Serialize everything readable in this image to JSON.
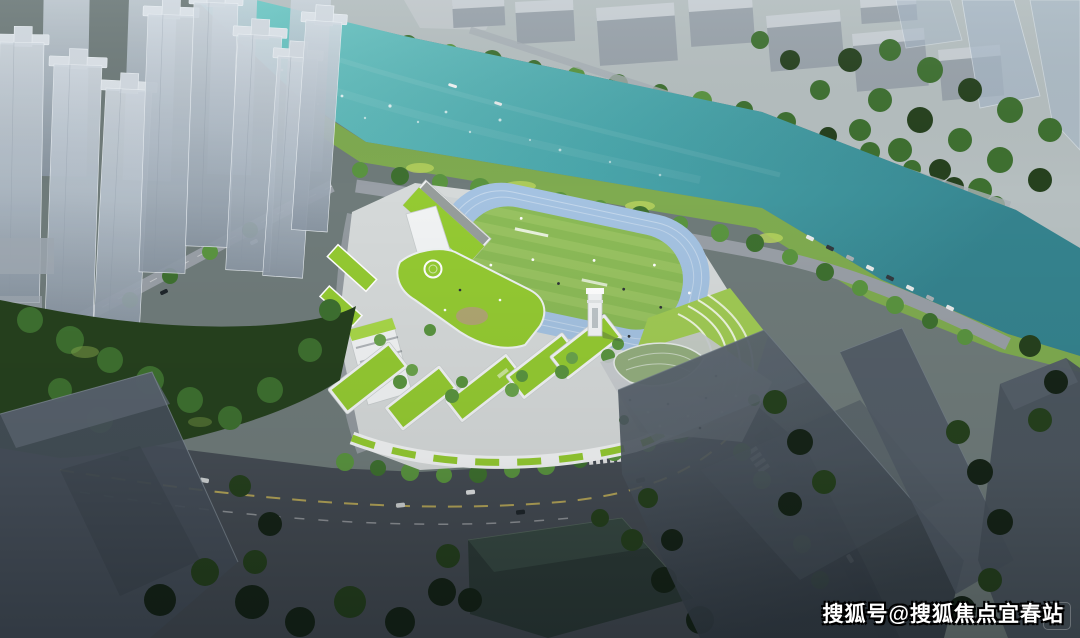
{
  "watermark": {
    "text": "搜狐号@搜狐焦点宜春站"
  },
  "faint_badge": {
    "glyph": "图"
  },
  "palette": {
    "water_light": "#73ccc8",
    "water_mid": "#4aa6ab",
    "water_deep": "#35838e",
    "far_ground": "#b6bfc0",
    "context_building": "#99a2aa",
    "context_building_top": "#c9cfd4",
    "ghost_tower": "#a9b9c9",
    "tower_face": "#b4bfca",
    "tree_bright": "#5a9440",
    "tree_mid": "#3e7030",
    "tree_dark": "#26411e",
    "tree_black": "#162418",
    "grass_bank": "#7fae4e",
    "grass_lime": "#b9d45e",
    "campus_ground": "#d5d9d9",
    "campus_white": "#f1f3f4",
    "roof_green": "#94ca32",
    "roof_green_light": "#a8d748",
    "field_green": "#8bba57",
    "field_stripe": "#9ac463",
    "track_blue": "#a4c2e1",
    "terrace_green": "#a0ca54",
    "road_light": "#999fa6",
    "road_mid": "#6e757d",
    "road_dark": "#454c54",
    "asphalt_dark": "#2b3138",
    "slab_dark": "#46505a",
    "slab_mid": "#5b6570",
    "plaza_gray": "#c6cacd",
    "marking_yellow": "#d9c35b",
    "car_dark": "#1f262b",
    "wm_text": "#ffffff",
    "wm_outline": "#000000"
  }
}
